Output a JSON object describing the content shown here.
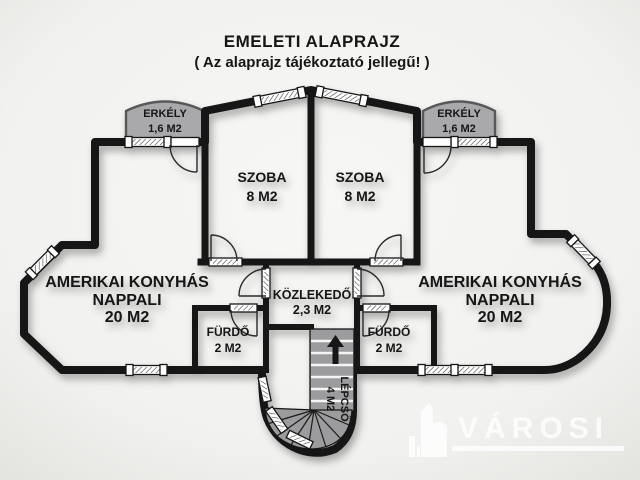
{
  "title": {
    "line1": "EMELETI ALAPRAJZ",
    "line2": "( Az alaprajz tájékoztató jellegű! )"
  },
  "rooms": {
    "balcony_left": {
      "name": "ERKÉLY",
      "area": "1,6 M2"
    },
    "balcony_right": {
      "name": "ERKÉLY",
      "area": "1,6 M2"
    },
    "bedroom_left": {
      "name": "SZOBA",
      "area": "8 M2"
    },
    "bedroom_right": {
      "name": "SZOBA",
      "area": "8 M2"
    },
    "living_left": {
      "name_line1": "AMERIKAI KONYHÁS",
      "name_line2": "NAPPALI",
      "area": "20 M2"
    },
    "living_right": {
      "name_line1": "AMERIKAI KONYHÁS",
      "name_line2": "NAPPALI",
      "area": "20 M2"
    },
    "corridor": {
      "name": "KÖZLEKEDŐ",
      "area": "2,3 M2"
    },
    "bathroom_left": {
      "name": "FÜRDŐ",
      "area": "2 M2"
    },
    "bathroom_right": {
      "name": "FÜRDŐ",
      "area": "2 M2"
    },
    "staircase": {
      "name": "LÉPCSŐ",
      "area": "4 M2"
    }
  },
  "watermark": {
    "brand": "VÁROSI"
  },
  "colors": {
    "floor": "#f3d9ac",
    "wall": "#121212",
    "balcony_fill": "#a9a9ab",
    "balcony_border": "#58585a",
    "stairs_fill": "#9c9c9e",
    "background": "#f2f2f0"
  }
}
